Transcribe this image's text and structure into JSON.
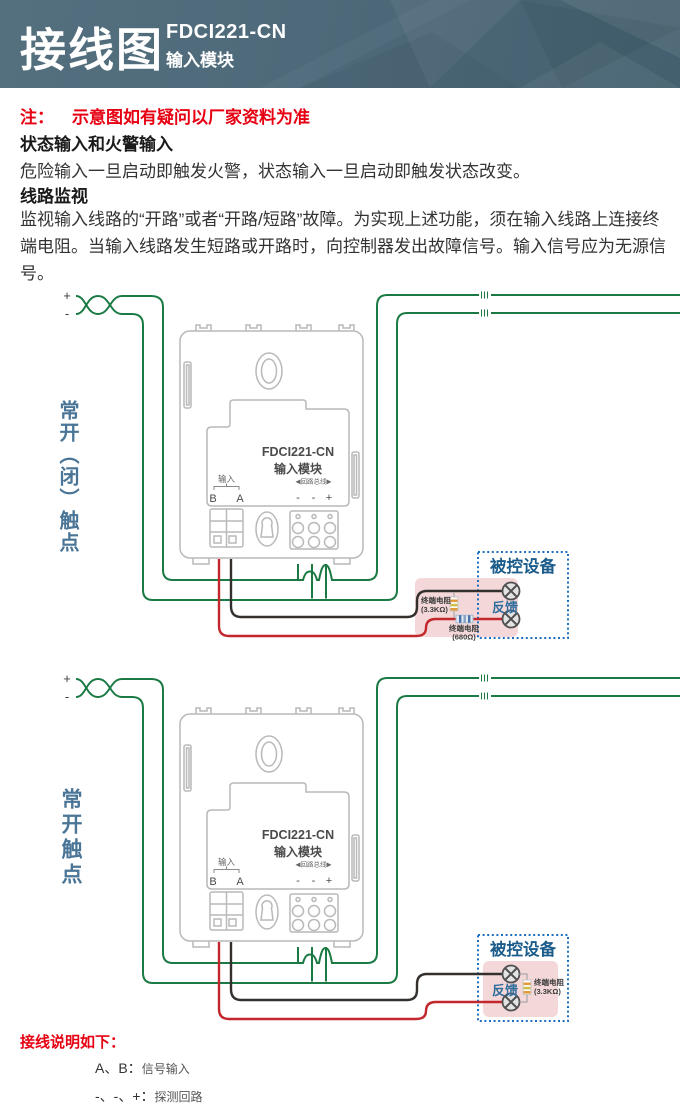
{
  "header": {
    "title": "接线图",
    "model": "FDCI221-CN",
    "product": "输入模块"
  },
  "notes": {
    "note_label": "注：",
    "note_text": "示意图如有疑问以厂家资料为准",
    "section1_title": "状态输入和火警输入",
    "section1_body": "危险输入一旦启动即触发火警，状态输入一旦启动即触发状态改变。",
    "section2_title": "线路监视",
    "section2_body": "监视输入线路的“开路”或者“开路/短路”故障。为实现上述功能，须在输入线路上连接终端电阻。当输入线路发生短路或开路时，向控制器发出故障信号。输入信号应为无源信号。"
  },
  "module": {
    "title": "FDCI221-CN",
    "subtitle": "输入模块",
    "input_label": "输入",
    "terminal_b": "B",
    "terminal_a": "A",
    "loop_label": "◀回路总线▶",
    "loop_terminals": [
      "-",
      "-",
      "+"
    ]
  },
  "circuit": {
    "plus": "+",
    "minus": "-",
    "device_box_label": "被控设备",
    "feedback_label": "反馈"
  },
  "diagram1": {
    "side_label": "常开（闭）触点",
    "resistor1_name": "终端电阻",
    "resistor1_value": "(3.3KΩ)",
    "resistor2_name": "终端电阻",
    "resistor2_value": "(680Ω)"
  },
  "diagram2": {
    "side_label": "常开触点",
    "resistor1_name": "终端电阻",
    "resistor1_value": "(3.3KΩ)"
  },
  "legend": {
    "title": "接线说明如下：",
    "items": [
      {
        "term": "A、B：",
        "desc": "信号输入"
      },
      {
        "term": "-、-、+：",
        "desc": "探测回路"
      }
    ]
  },
  "colors": {
    "loop_wire": "#1b7a44",
    "signal_wire_red": "#c1272d",
    "signal_wire_black": "#34302d",
    "device_box_border": "#1f6fc0",
    "device_fill": "#f4d8d9",
    "accent_blue_text": "#1c5c8b"
  }
}
